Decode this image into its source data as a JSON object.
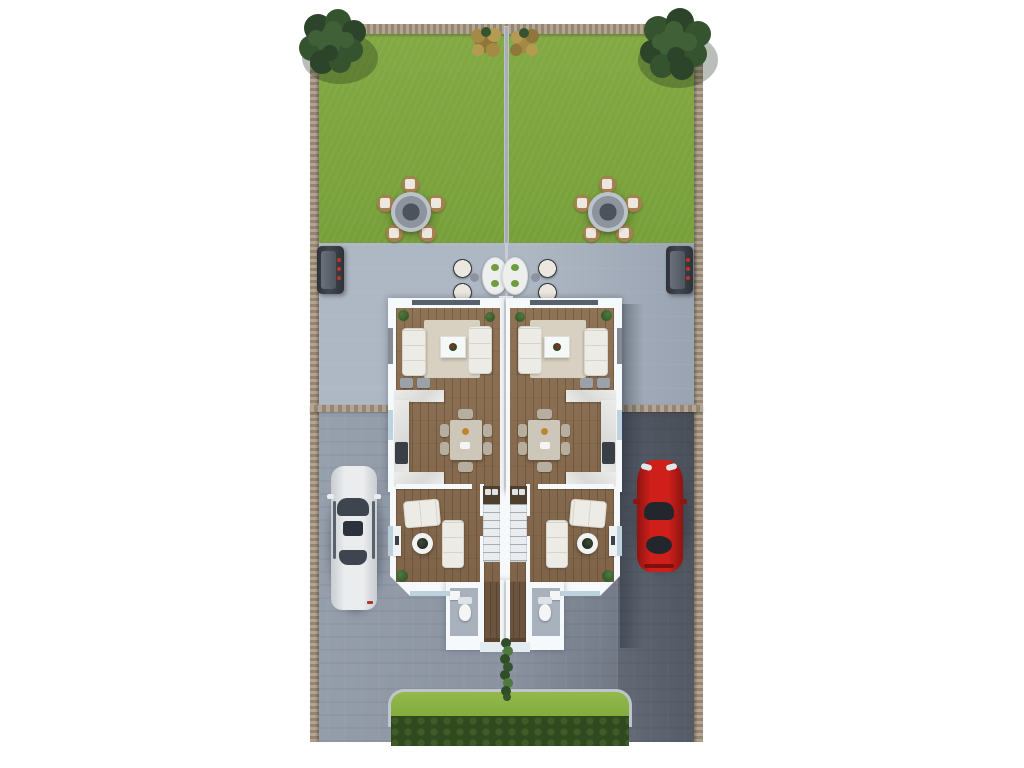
{
  "meta": {
    "title": "Semi-detached duplex site plan - 3D top-down render",
    "type": "architectural-3d-floor-plan",
    "view": "top-down"
  },
  "colors": {
    "bg": "#ffffff",
    "lawn1": "#83a944",
    "lawn2": "#78a03a",
    "patio1": "#aeb7c4",
    "patio2": "#99a2b0",
    "drive1": "#98a1ae",
    "drive2": "#8a92a0",
    "drive3": "#5b616c",
    "shade": "rgba(28,33,44,0.38)",
    "fenceA": "#b4a592",
    "fenceB": "#948672",
    "dividerFence": "#a9aeb5",
    "sideLine": "#c6ccd2",
    "wall": "#f6f9fb",
    "wallEdge": "#e4ebf0",
    "wood1": "#8e7356",
    "wood2": "#7f644a",
    "woodLine": "rgba(60,40,20,0.28)",
    "woodHall": "#6b543e",
    "woodDark": "#4e3e2e",
    "rug": "#d8d1c1",
    "sofa": "#edebe5",
    "sofaLine": "#d7d4ca",
    "counter1": "#ececea",
    "counter2": "#d9d9d7",
    "stool": "#9aa1ab",
    "dtable": "#cdc7b9",
    "dchair": "#b6ae9e",
    "bathFloor": "#a9b1bc",
    "porcelain": "#f3f5f7",
    "porcelainShade": "#dde2e6",
    "stairTread": "#e9edf0",
    "glassDark": "#46505c",
    "glassLight": "#bed2de",
    "hedgeCurb": "#bfc5cc",
    "hedgeTop1": "#93b94a",
    "hedgeTop2": "#7fa83c",
    "hedgeFront": "#31491f",
    "hedgeBlob": "#3f5c28",
    "tree1": "#2c4429",
    "tree2": "#36532f",
    "tree3": "#406137",
    "treeShadow": "rgba(25,40,20,0.30)",
    "gold1": "#a58a46",
    "gold2": "#8f763a",
    "gold3": "#b59a52",
    "plantDark": "#2f4d26",
    "plantLight": "#4e7a3c",
    "gtableOuter": "#bcc2ca",
    "gtableMid": "#8d949e",
    "gtableCenter": "#4d535c",
    "gchair": "#a87f52",
    "cushion": "#ece8e0",
    "pchairRim": "#33383e",
    "ptable": "#edefee",
    "pgreen": "#6f9c3d",
    "pside": "#8d949e",
    "grill1": "#42474f",
    "grill2": "#2e3238",
    "knob": "#c03428",
    "carWhite1": "#eaeced",
    "carWhite2": "#c9cdd1",
    "carGlass1": "#3e454f",
    "carGlass2": "#2c323b",
    "carRed1": "#cf1f1a",
    "carRed2": "#8e1410",
    "carRedGlass": "#23272d",
    "headlight": "#e3e7ea",
    "taillight": "#7e100d",
    "doorWood": "#5a432f"
  },
  "scene": {
    "site": [
      "back-garden-left",
      "back-garden-right",
      "patio",
      "driveway",
      "front-hedge",
      "perimeter-fence",
      "garden-divider-fence"
    ],
    "vehicles": [
      "white-car",
      "red-car"
    ],
    "units": [
      "duplex-unit-left",
      "duplex-unit-right"
    ],
    "rooms_per_unit": [
      "living-room",
      "kitchen",
      "dining-area",
      "sitting-room",
      "staircase",
      "hallway",
      "bathroom"
    ],
    "garden_objects": [
      "tree",
      "autumn-bush",
      "garden-table-set",
      "lounge-chair-set",
      "patio-table",
      "bbq-grill",
      "front-path-plants"
    ]
  }
}
